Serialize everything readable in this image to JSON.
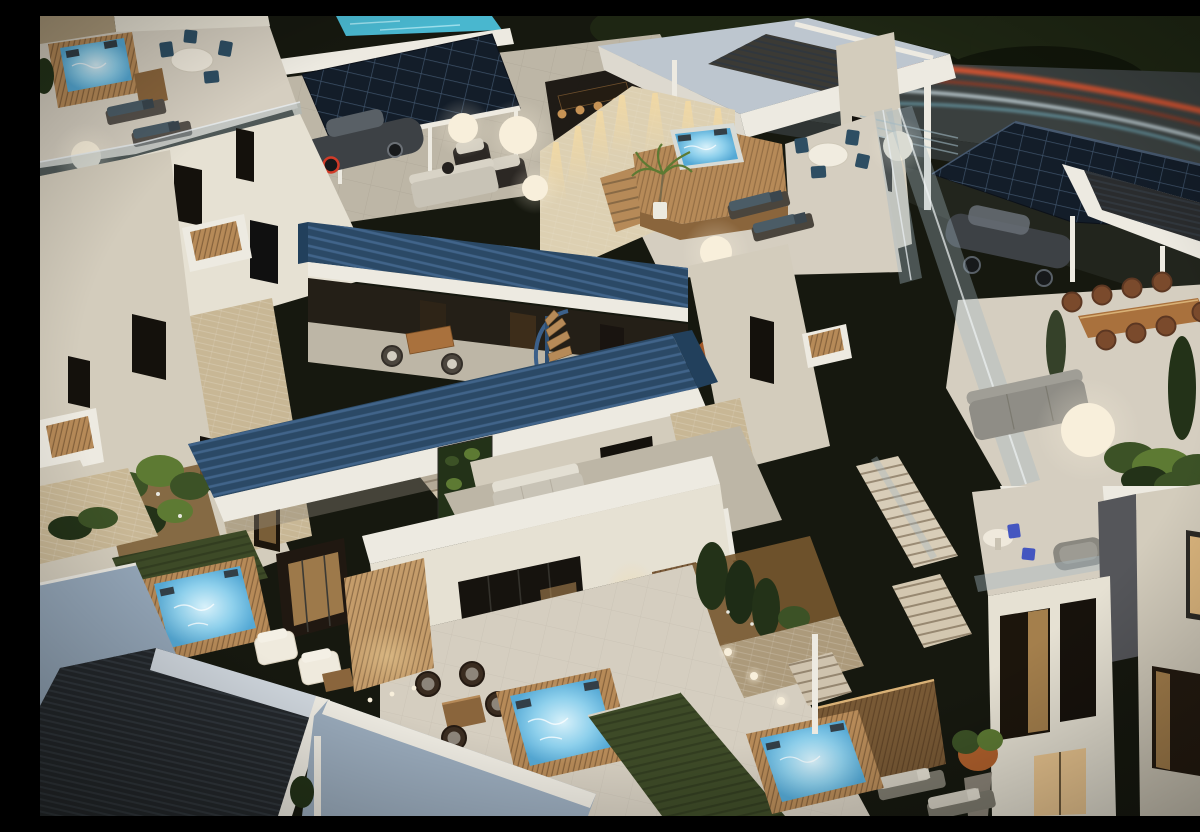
{
  "scene": {
    "type": "architectural-3d-render",
    "setting": "Modern multi-level apartment complex at dusk",
    "view": "aerial three-quarter exterior render, evening lighting",
    "counts": {
      "hot_tubs": 6,
      "glow_lamps": 7,
      "cars": 2,
      "solar_arrays": 2,
      "pergolas": 3,
      "staircases": 5
    }
  },
  "objects": [
    {
      "id": "rooftop-terrace-left",
      "label": "roof terrace with hot tub, dining set and sun loungers"
    },
    {
      "id": "rooftop-terrace-center",
      "label": "roof terrace with raised wooden hot tub deck and palm"
    },
    {
      "id": "solar-carport-left",
      "label": "solar panel canopy over parked car"
    },
    {
      "id": "solar-array-right",
      "label": "large rooftop solar array"
    },
    {
      "id": "light-trails",
      "label": "car light trails on the road behind"
    },
    {
      "id": "pergola-louvers",
      "label": "steel-blue louvered pergola roofs"
    },
    {
      "id": "dining-terrace-right",
      "label": "terrace with long wooden dining table and eight chairs"
    },
    {
      "id": "balcony-blue-chairs",
      "label": "balcony with round table and blue bistro chairs"
    },
    {
      "id": "ground-patio",
      "label": "ground patio with wicker lounge set and glowing hot tub"
    },
    {
      "id": "slate-roof",
      "label": "dark ribbed roof, lower left"
    },
    {
      "id": "vertical-garden",
      "label": "green plant wall"
    },
    {
      "id": "glow-lamps",
      "label": "spherical glowing garden lamps"
    },
    {
      "id": "lap-pool",
      "label": "aqua lap pool sliver between roofs"
    }
  ],
  "palette": {
    "night": "#16180f",
    "foliage": "#1e2613",
    "foliage_dark": "#11160a",
    "ground_dark": "#22251d",
    "road": "#3a403f",
    "road_low": "#2f3433",
    "trail_red": "#e05330",
    "trail_red_dim": "#9c3a22",
    "trail_white": "#dcedf4",
    "trail_cyan": "#7ec6da",
    "pool_aqua": "#49b7cf",
    "solar": "#131d29",
    "solar_line": "#3d5168",
    "solar_edge": "#46586e",
    "slate": "#24282c",
    "slate_line": "#31373d",
    "carport_rib": "#2a2c2e",
    "roof_steel": "#93a5b7",
    "roof_steel_light": "#bdc6cf",
    "roof_steel2": "#9aabbc",
    "pergola": "#2b4966",
    "pergola_dark": "#22405c",
    "pergola_line": "#41648a",
    "fascia": "#edeae1",
    "wall": "#e6e1d3",
    "wall_dim": "#d3ccbc",
    "wall_dark": "#bdb5a4",
    "wall_warm": "#ddd0b2",
    "brick": "#c8b795",
    "brick_dim": "#ac9a7b",
    "paving": "#d5cec0",
    "paving_dim": "#bdb6a6",
    "wood": "#b68a58",
    "wood_dark": "#8a653c",
    "wood_lit": "#d9b176",
    "screen_wood": "#c49c6a",
    "water_hi": "#d8f1fa",
    "water": "#8ed0ec",
    "water_lo": "#55a9d5",
    "glow": "#f8efdb",
    "warm_light": "#f3d9a2",
    "interior_warm": "#c79a5d",
    "interior_glow": "#ecc285",
    "win_dark": "#14110c",
    "glass": "#a4b8c2",
    "green": "#3c5226",
    "green_hi": "#5d7a33",
    "green_dark": "#233218",
    "grass": "#3d4a27",
    "mulch": "#77582f",
    "cushion": "#d3cec1",
    "cushion_teal": "#4b5c66",
    "chair_blue": "#2e4e63",
    "chair_royal": "#4456c0",
    "chair_brown": "#7a4a2c",
    "table_wood": "#a9713d",
    "sofa_gray": "#8f8d86",
    "sofa_light": "#c8c3b6",
    "car_body": "#3d4145",
    "car_hi": "#656c72",
    "black": "#17191b",
    "headrest": "#333f47",
    "frame_dark": "#3a2c20"
  }
}
